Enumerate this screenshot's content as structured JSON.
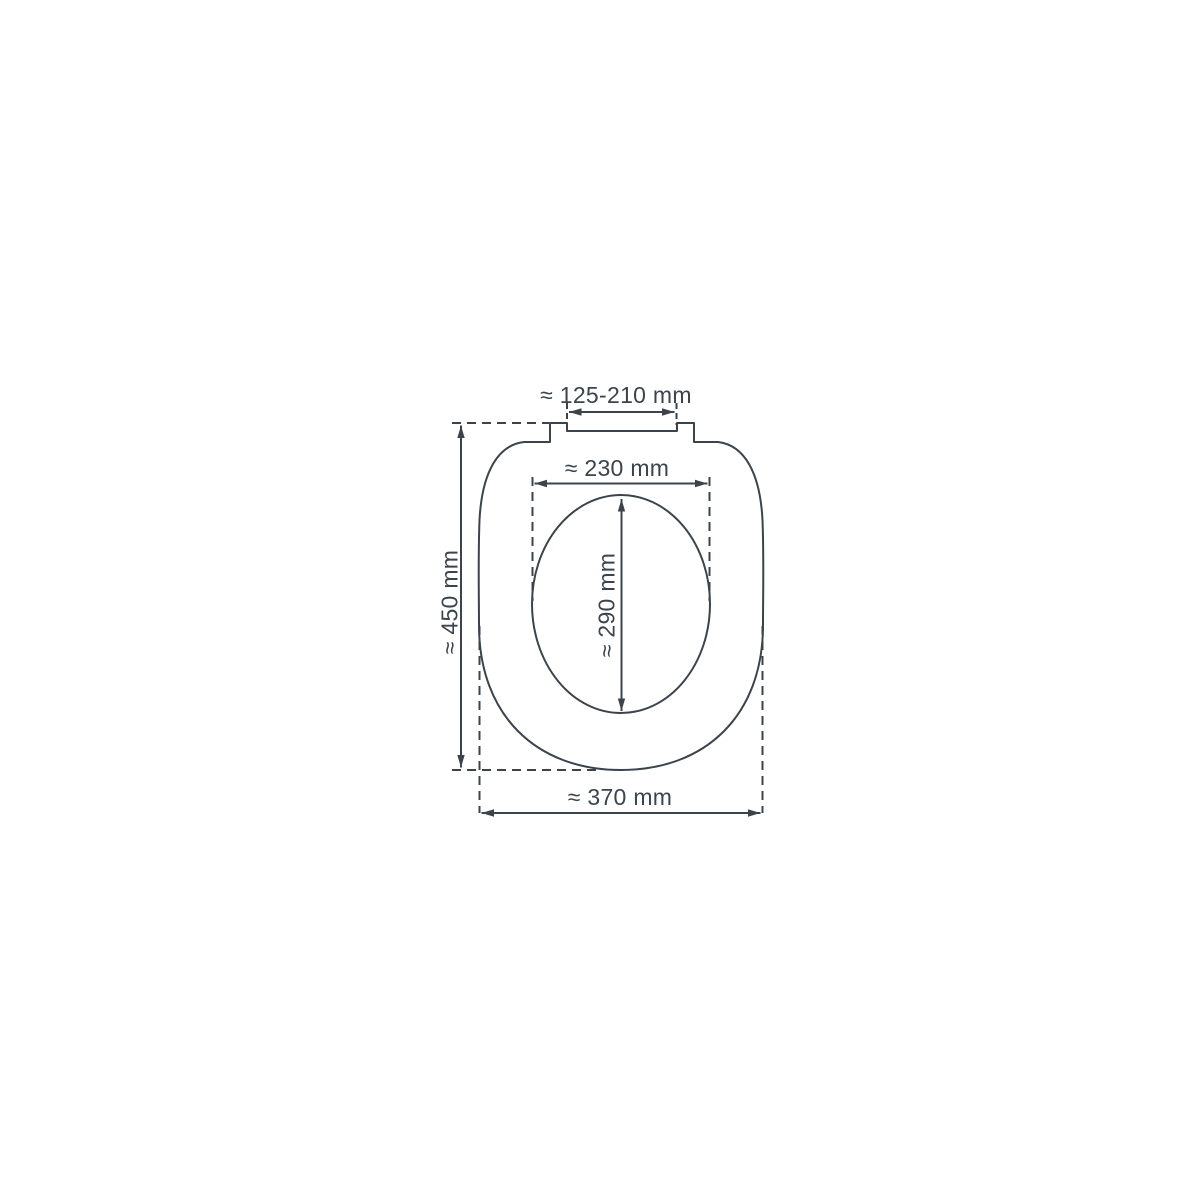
{
  "diagram": {
    "subject": "toilet-seat-top-view-dimension-drawing",
    "unit": "mm",
    "line_color": "#3b444c",
    "background_color": "#ffffff",
    "dimensions": {
      "hinge_width": {
        "label": "≈ 125-210 mm",
        "value": "125-210",
        "orientation": "horizontal"
      },
      "inner_width": {
        "label": "≈ 230 mm",
        "value": "230",
        "orientation": "horizontal"
      },
      "inner_length": {
        "label": "≈ 290 mm",
        "value": "290",
        "orientation": "vertical"
      },
      "outer_length": {
        "label": "≈ 450 mm",
        "value": "450",
        "orientation": "vertical"
      },
      "outer_width": {
        "label": "≈ 370 mm",
        "value": "370",
        "orientation": "horizontal"
      }
    }
  }
}
